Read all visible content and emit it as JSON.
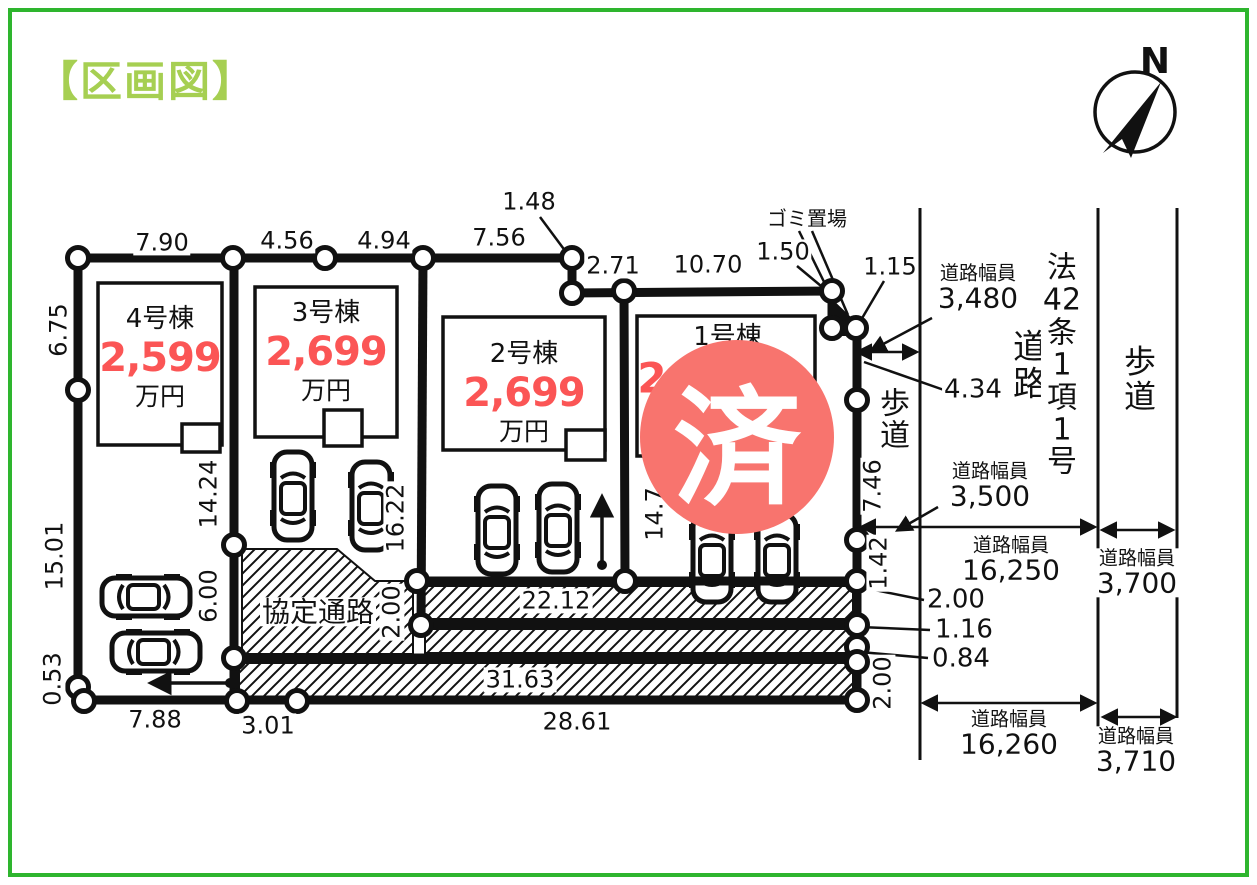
{
  "page": {
    "title": "【区画図】"
  },
  "colors": {
    "frame_green": "#2eb52e",
    "title_green": "#a6cf52",
    "price_red": "#fb5555",
    "stamp_red": "#f8746e",
    "line_black": "#111111"
  },
  "compass": {
    "label": "N"
  },
  "stamp": {
    "text": "済"
  },
  "lots": [
    {
      "id": "4",
      "name": "4号棟",
      "price": "2,599",
      "unit": "万円"
    },
    {
      "id": "3",
      "name": "3号棟",
      "price": "2,699",
      "unit": "万円"
    },
    {
      "id": "2",
      "name": "2号棟",
      "price": "2,699",
      "unit": "万円"
    },
    {
      "id": "1",
      "name": "1号棟",
      "price": "2",
      "unit": ""
    }
  ],
  "annotations": [
    {
      "name": "dim-top-1",
      "text": "7.90",
      "x": 162,
      "y": 243
    },
    {
      "name": "dim-top-2",
      "text": "4.56",
      "x": 287,
      "y": 241
    },
    {
      "name": "dim-top-3",
      "text": "4.94",
      "x": 384,
      "y": 241
    },
    {
      "name": "dim-top-4",
      "text": "7.56",
      "x": 499,
      "y": 238
    },
    {
      "name": "dim-top-5",
      "text": "1.48",
      "x": 529,
      "y": 202
    },
    {
      "name": "dim-top-6",
      "text": "2.71",
      "x": 613,
      "y": 266
    },
    {
      "name": "dim-top-7",
      "text": "10.70",
      "x": 708,
      "y": 265
    },
    {
      "name": "dim-top-8",
      "text": "1.50",
      "x": 783,
      "y": 252
    },
    {
      "name": "dim-top-9",
      "text": "1.15",
      "x": 890,
      "y": 267
    },
    {
      "name": "garbage-label",
      "text": "ゴミ置場",
      "x": 807,
      "y": 219,
      "size": 20
    },
    {
      "name": "dim-left-1",
      "text": "6.75",
      "x": 59,
      "y": 330,
      "rot": -90
    },
    {
      "name": "dim-left-2",
      "text": "15.01",
      "x": 55,
      "y": 556,
      "rot": -90
    },
    {
      "name": "dim-left-3",
      "text": "0.53",
      "x": 53,
      "y": 679,
      "rot": -90
    },
    {
      "name": "dim-lot4-depth",
      "text": "14.24",
      "x": 209,
      "y": 494,
      "rot": -90
    },
    {
      "name": "dim-lot4-6",
      "text": "6.00",
      "x": 209,
      "y": 596,
      "rot": -90
    },
    {
      "name": "dim-lot3-depth",
      "text": "16.22",
      "x": 396,
      "y": 518,
      "rot": -90
    },
    {
      "name": "dim-strip-200",
      "text": "2.00",
      "x": 392,
      "y": 612,
      "rot": -90
    },
    {
      "name": "dim-lot1-depth",
      "text": "14.7",
      "x": 655,
      "y": 514,
      "rot": -90
    },
    {
      "name": "dim-right-746",
      "text": "7.46",
      "x": 873,
      "y": 486,
      "rot": -90
    },
    {
      "name": "dim-right-142",
      "text": "1.42",
      "x": 879,
      "y": 563,
      "rot": -90
    },
    {
      "name": "dim-right-200",
      "text": "2.00",
      "x": 883,
      "y": 683,
      "rot": -90
    },
    {
      "name": "dim-bottom-1",
      "text": "7.88",
      "x": 155,
      "y": 720
    },
    {
      "name": "dim-bottom-2",
      "text": "3.01",
      "x": 268,
      "y": 726
    },
    {
      "name": "dim-bottom-3",
      "text": "28.61",
      "x": 577,
      "y": 722
    },
    {
      "name": "dim-strip-2212",
      "text": "22.12",
      "x": 556,
      "y": 601
    },
    {
      "name": "dim-strip-3163",
      "text": "31.63",
      "x": 520,
      "y": 680
    },
    {
      "name": "passage-label",
      "text": "協定通路",
      "x": 318,
      "y": 612,
      "size": 28
    },
    {
      "name": "dim-leader-200",
      "text": "2.00",
      "x": 956,
      "y": 600,
      "size": 26
    },
    {
      "name": "dim-leader-116",
      "text": "1.16",
      "x": 964,
      "y": 630,
      "size": 26
    },
    {
      "name": "dim-leader-084",
      "text": "0.84",
      "x": 961,
      "y": 659,
      "size": 26
    },
    {
      "name": "dim-434",
      "text": "4.34",
      "x": 973,
      "y": 390,
      "size": 26
    },
    {
      "name": "road-width-3480",
      "caption": "道路幅員",
      "value": "3,480",
      "x": 978,
      "y": 288,
      "size": 28
    },
    {
      "name": "road-width-3500",
      "caption": "道路幅員",
      "value": "3,500",
      "x": 990,
      "y": 486,
      "size": 28
    },
    {
      "name": "road-width-16250",
      "caption": "道路幅員",
      "value": "16,250",
      "x": 1011,
      "y": 560,
      "size": 28
    },
    {
      "name": "road-width-3700",
      "caption": "道路幅員",
      "value": "3,700",
      "x": 1137,
      "y": 573,
      "size": 28
    },
    {
      "name": "road-width-16260",
      "caption": "道路幅員",
      "value": "16,260",
      "x": 1009,
      "y": 734,
      "size": 28
    },
    {
      "name": "road-width-3710",
      "caption": "道路幅員",
      "value": "3,710",
      "x": 1136,
      "y": 751,
      "size": 28
    },
    {
      "name": "sidewalk-label-inner",
      "lines": [
        "歩",
        "道"
      ],
      "x": 895,
      "y": 421,
      "size": 30
    },
    {
      "name": "sidewalk-label-right",
      "lines": [
        "歩",
        "道"
      ],
      "x": 1140,
      "y": 379,
      "size": 32
    },
    {
      "name": "road-label",
      "lines": [
        "道",
        "路"
      ],
      "x": 1030,
      "y": 366,
      "size": 34
    },
    {
      "name": "road-law-label",
      "lines": [
        "法",
        "42",
        "条",
        "1",
        "項",
        "1",
        "号"
      ],
      "x": 1062,
      "y": 366,
      "size": 30
    },
    {
      "name": "compass-n-label",
      "text": "N",
      "x": 1155,
      "y": 62,
      "size": 36,
      "bold": true,
      "bg": false
    }
  ]
}
